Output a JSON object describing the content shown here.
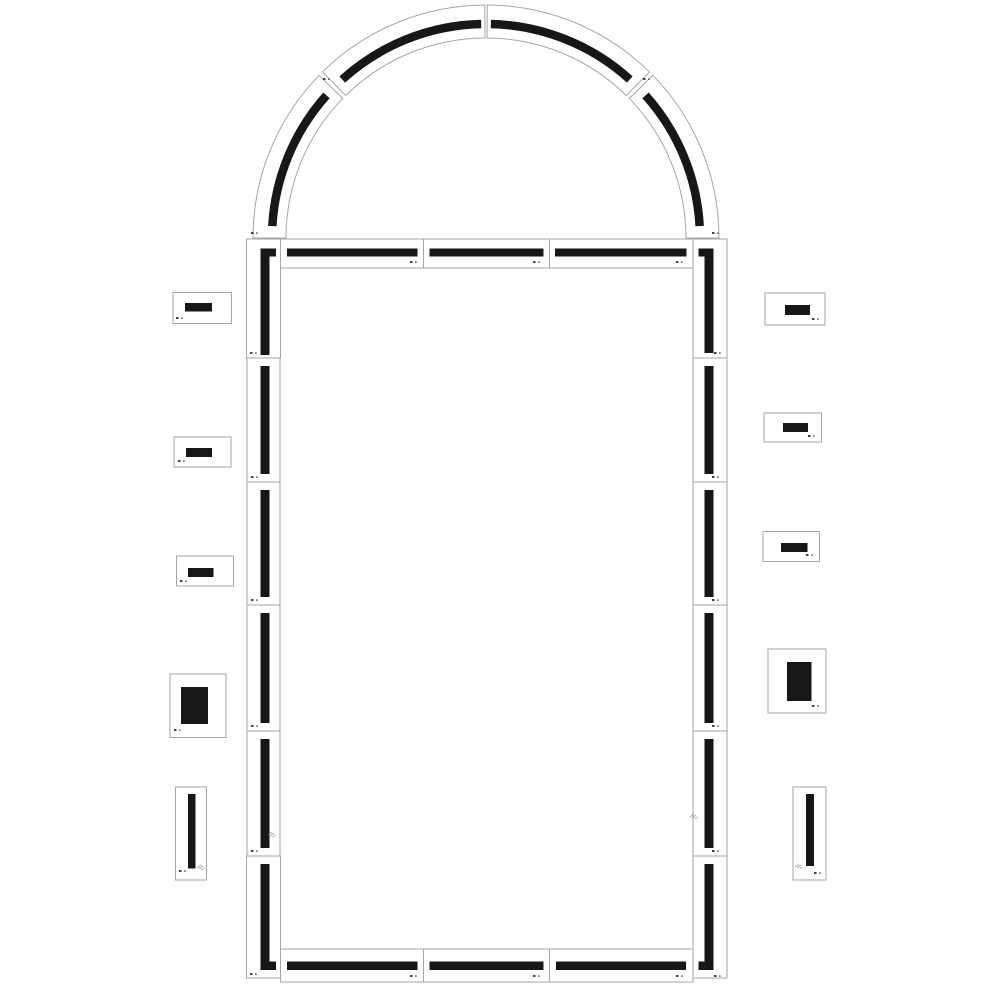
{
  "meta": {
    "description": "Technical parts diagram of an arched frame kit: assembled arch-top frame made of segmented pieces plus ten loose side pieces"
  },
  "canvas": {
    "w": 1000,
    "h": 1000,
    "bg": "#ffffff"
  },
  "style": {
    "card_fill": "#ffffff",
    "card_stroke": "#a6a6a6",
    "card_stroke_w": 1,
    "bar_color": "#171717",
    "mark_color": "#222222",
    "watermark_color": "#8c8c8c"
  },
  "arch": {
    "cx": 486,
    "cy": 238,
    "r_outer": 233,
    "r_inner": 200,
    "stripe_r": 214,
    "stripe_w": 8.5,
    "segments": [
      {
        "id": "arch-segment-left-lower",
        "a1": 180,
        "a2": 135.75,
        "s1": 176.8,
        "s2": 138.2
      },
      {
        "id": "arch-segment-left-upper",
        "a1": 134.55,
        "a2": 90.3,
        "s1": 132.2,
        "s2": 91.3
      },
      {
        "id": "arch-segment-right-upper",
        "a1": 89.7,
        "a2": 45.45,
        "s1": 88.7,
        "s2": 47.8
      },
      {
        "id": "arch-segment-right-lower",
        "a1": 44.25,
        "a2": 0,
        "s1": 41.8,
        "s2": 3.2
      }
    ],
    "marks": [
      {
        "x": 323,
        "y": 78
      },
      {
        "x": 643,
        "y": 78
      },
      {
        "x": 251,
        "y": 232
      },
      {
        "x": 712,
        "y": 232
      }
    ]
  },
  "assembled_pieces": [
    {
      "id": "corner-top-left",
      "x": 246.5,
      "y": 239,
      "w": 34,
      "h": 119,
      "bars": [
        {
          "x": 260.5,
          "y": 248.5,
          "w": 9,
          "h": 106.5
        },
        {
          "x": 260.5,
          "y": 248.5,
          "w": 15.5,
          "h": 8
        }
      ],
      "marks": [
        {
          "x": 250,
          "y": 352
        }
      ]
    },
    {
      "id": "top-band-1",
      "x": 280.5,
      "y": 239,
      "w": 143,
      "h": 29,
      "bars": [
        {
          "x": 287,
          "y": 248.5,
          "w": 130.5,
          "h": 8
        }
      ],
      "marks": [
        {
          "x": 410,
          "y": 261
        }
      ]
    },
    {
      "id": "top-band-2",
      "x": 423.5,
      "y": 239,
      "w": 126,
      "h": 29,
      "bars": [
        {
          "x": 429.5,
          "y": 248.5,
          "w": 114,
          "h": 8
        }
      ],
      "marks": [
        {
          "x": 533,
          "y": 261
        }
      ]
    },
    {
      "id": "top-band-3",
      "x": 549.5,
      "y": 239,
      "w": 143.5,
      "h": 29,
      "bars": [
        {
          "x": 555,
          "y": 248.5,
          "w": 131.5,
          "h": 8
        }
      ],
      "marks": [
        {
          "x": 676,
          "y": 261
        }
      ]
    },
    {
      "id": "corner-top-right",
      "x": 693,
      "y": 239,
      "w": 34,
      "h": 119,
      "bars": [
        {
          "x": 704.5,
          "y": 248.5,
          "w": 9,
          "h": 104.5
        },
        {
          "x": 698.5,
          "y": 248.5,
          "w": 15,
          "h": 8
        }
      ],
      "marks": [
        {
          "x": 714,
          "y": 352
        }
      ]
    },
    {
      "id": "left-column-1",
      "x": 247,
      "y": 358,
      "w": 33,
      "h": 124,
      "bars": [
        {
          "x": 260.5,
          "y": 366,
          "w": 9,
          "h": 108
        }
      ],
      "marks": [
        {
          "x": 251,
          "y": 476
        }
      ]
    },
    {
      "id": "left-column-2",
      "x": 247,
      "y": 482,
      "w": 33,
      "h": 123,
      "bars": [
        {
          "x": 260.5,
          "y": 490,
          "w": 9,
          "h": 107
        }
      ],
      "marks": [
        {
          "x": 251,
          "y": 599
        }
      ]
    },
    {
      "id": "left-column-3",
      "x": 247,
      "y": 605,
      "w": 33,
      "h": 126,
      "bars": [
        {
          "x": 260.5,
          "y": 613,
          "w": 9,
          "h": 110
        }
      ],
      "marks": [
        {
          "x": 251,
          "y": 725
        }
      ]
    },
    {
      "id": "left-column-4",
      "x": 247,
      "y": 731,
      "w": 33,
      "h": 125,
      "bars": [
        {
          "x": 260.5,
          "y": 739,
          "w": 9,
          "h": 109
        }
      ],
      "marks": [
        {
          "x": 251,
          "y": 850
        }
      ]
    },
    {
      "id": "right-column-1",
      "x": 693,
      "y": 358,
      "w": 34,
      "h": 124,
      "bars": [
        {
          "x": 704.5,
          "y": 366,
          "w": 9,
          "h": 108
        }
      ],
      "marks": [
        {
          "x": 712,
          "y": 476
        }
      ]
    },
    {
      "id": "right-column-2",
      "x": 693,
      "y": 482,
      "w": 34,
      "h": 123,
      "bars": [
        {
          "x": 704.5,
          "y": 490,
          "w": 9,
          "h": 107
        }
      ],
      "marks": [
        {
          "x": 712,
          "y": 599
        }
      ]
    },
    {
      "id": "right-column-3",
      "x": 693,
      "y": 605,
      "w": 34,
      "h": 126,
      "bars": [
        {
          "x": 704.5,
          "y": 613,
          "w": 9,
          "h": 110
        }
      ],
      "marks": [
        {
          "x": 712,
          "y": 725
        }
      ]
    },
    {
      "id": "right-column-4",
      "x": 693,
      "y": 731,
      "w": 34,
      "h": 125,
      "bars": [
        {
          "x": 704.5,
          "y": 739,
          "w": 9,
          "h": 109
        }
      ],
      "marks": [
        {
          "x": 712,
          "y": 850
        }
      ]
    },
    {
      "id": "corner-bottom-left",
      "x": 246.5,
      "y": 856,
      "w": 34,
      "h": 122,
      "bars": [
        {
          "x": 260.5,
          "y": 864,
          "w": 9,
          "h": 106
        },
        {
          "x": 260.5,
          "y": 961.5,
          "w": 15.5,
          "h": 8.5
        }
      ],
      "marks": [
        {
          "x": 250,
          "y": 973
        }
      ]
    },
    {
      "id": "bottom-band-1",
      "x": 280.5,
      "y": 949,
      "w": 143,
      "h": 33,
      "bars": [
        {
          "x": 287,
          "y": 961.5,
          "w": 130.5,
          "h": 8.5
        }
      ],
      "marks": [
        {
          "x": 410,
          "y": 975
        }
      ]
    },
    {
      "id": "bottom-band-2",
      "x": 423.5,
      "y": 949,
      "w": 126,
      "h": 33,
      "bars": [
        {
          "x": 429.5,
          "y": 961.5,
          "w": 114,
          "h": 8.5
        }
      ],
      "marks": [
        {
          "x": 533,
          "y": 975
        }
      ]
    },
    {
      "id": "bottom-band-3",
      "x": 549.5,
      "y": 949,
      "w": 143.5,
      "h": 33,
      "bars": [
        {
          "x": 556,
          "y": 961.5,
          "w": 130,
          "h": 8.5
        }
      ],
      "marks": [
        {
          "x": 676,
          "y": 975
        }
      ]
    },
    {
      "id": "corner-bottom-right",
      "x": 693,
      "y": 856,
      "w": 34,
      "h": 122,
      "bars": [
        {
          "x": 704.5,
          "y": 864,
          "w": 9,
          "h": 106
        },
        {
          "x": 698.5,
          "y": 961.5,
          "w": 15,
          "h": 8.5
        }
      ],
      "marks": [
        {
          "x": 714,
          "y": 975
        }
      ]
    }
  ],
  "loose_pieces": [
    {
      "id": "loose-left-1",
      "x": 173,
      "y": 292.5,
      "w": 58.5,
      "h": 31,
      "bars": [
        {
          "x": 185,
          "y": 303,
          "w": 27,
          "h": 8.5
        }
      ],
      "marks": [
        {
          "x": 176,
          "y": 317
        }
      ]
    },
    {
      "id": "loose-left-2",
      "x": 174,
      "y": 437,
      "w": 57,
      "h": 30,
      "bars": [
        {
          "x": 186,
          "y": 448,
          "w": 26,
          "h": 9
        }
      ],
      "marks": [
        {
          "x": 178,
          "y": 460
        }
      ]
    },
    {
      "id": "loose-left-3",
      "x": 176.5,
      "y": 556,
      "w": 57,
      "h": 30,
      "bars": [
        {
          "x": 188,
          "y": 568,
          "w": 25.5,
          "h": 9
        }
      ],
      "marks": [
        {
          "x": 180,
          "y": 580
        }
      ]
    },
    {
      "id": "loose-left-4",
      "x": 170,
      "y": 674,
      "w": 56,
      "h": 63.5,
      "bars": [
        {
          "x": 181,
          "y": 687,
          "w": 27,
          "h": 37
        }
      ],
      "marks": [
        {
          "x": 174,
          "y": 729
        }
      ]
    },
    {
      "id": "loose-left-5",
      "x": 175.5,
      "y": 787,
      "w": 31,
      "h": 93,
      "bars": [
        {
          "x": 188,
          "y": 794,
          "w": 7.5,
          "h": 74.5
        }
      ],
      "marks": [
        {
          "x": 179,
          "y": 870
        }
      ]
    },
    {
      "id": "loose-right-1",
      "x": 765,
      "y": 293,
      "w": 60,
      "h": 32,
      "bars": [
        {
          "x": 785,
          "y": 305,
          "w": 25,
          "h": 10
        }
      ],
      "marks": [
        {
          "x": 812,
          "y": 318
        }
      ]
    },
    {
      "id": "loose-right-2",
      "x": 764,
      "y": 413,
      "w": 57.5,
      "h": 29,
      "bars": [
        {
          "x": 783,
          "y": 423,
          "w": 25,
          "h": 9
        }
      ],
      "marks": [
        {
          "x": 808,
          "y": 435
        }
      ]
    },
    {
      "id": "loose-right-3",
      "x": 763,
      "y": 531.5,
      "w": 56.5,
      "h": 30,
      "bars": [
        {
          "x": 781,
          "y": 543,
          "w": 26.5,
          "h": 9
        }
      ],
      "marks": [
        {
          "x": 806,
          "y": 554
        }
      ]
    },
    {
      "id": "loose-right-4",
      "x": 768,
      "y": 649,
      "w": 58,
      "h": 64,
      "bars": [
        {
          "x": 787,
          "y": 662,
          "w": 24.5,
          "h": 39
        }
      ],
      "marks": [
        {
          "x": 812,
          "y": 705
        }
      ]
    },
    {
      "id": "loose-right-5",
      "x": 793,
      "y": 787,
      "w": 33,
      "h": 93,
      "bars": [
        {
          "x": 806,
          "y": 794,
          "w": 8,
          "h": 72
        }
      ],
      "marks": [
        {
          "x": 814,
          "y": 872
        }
      ]
    }
  ],
  "watermarks": [
    {
      "x": 268,
      "y": 831
    },
    {
      "x": 690,
      "y": 813
    },
    {
      "x": 197,
      "y": 864
    },
    {
      "x": 795,
      "y": 863
    }
  ]
}
